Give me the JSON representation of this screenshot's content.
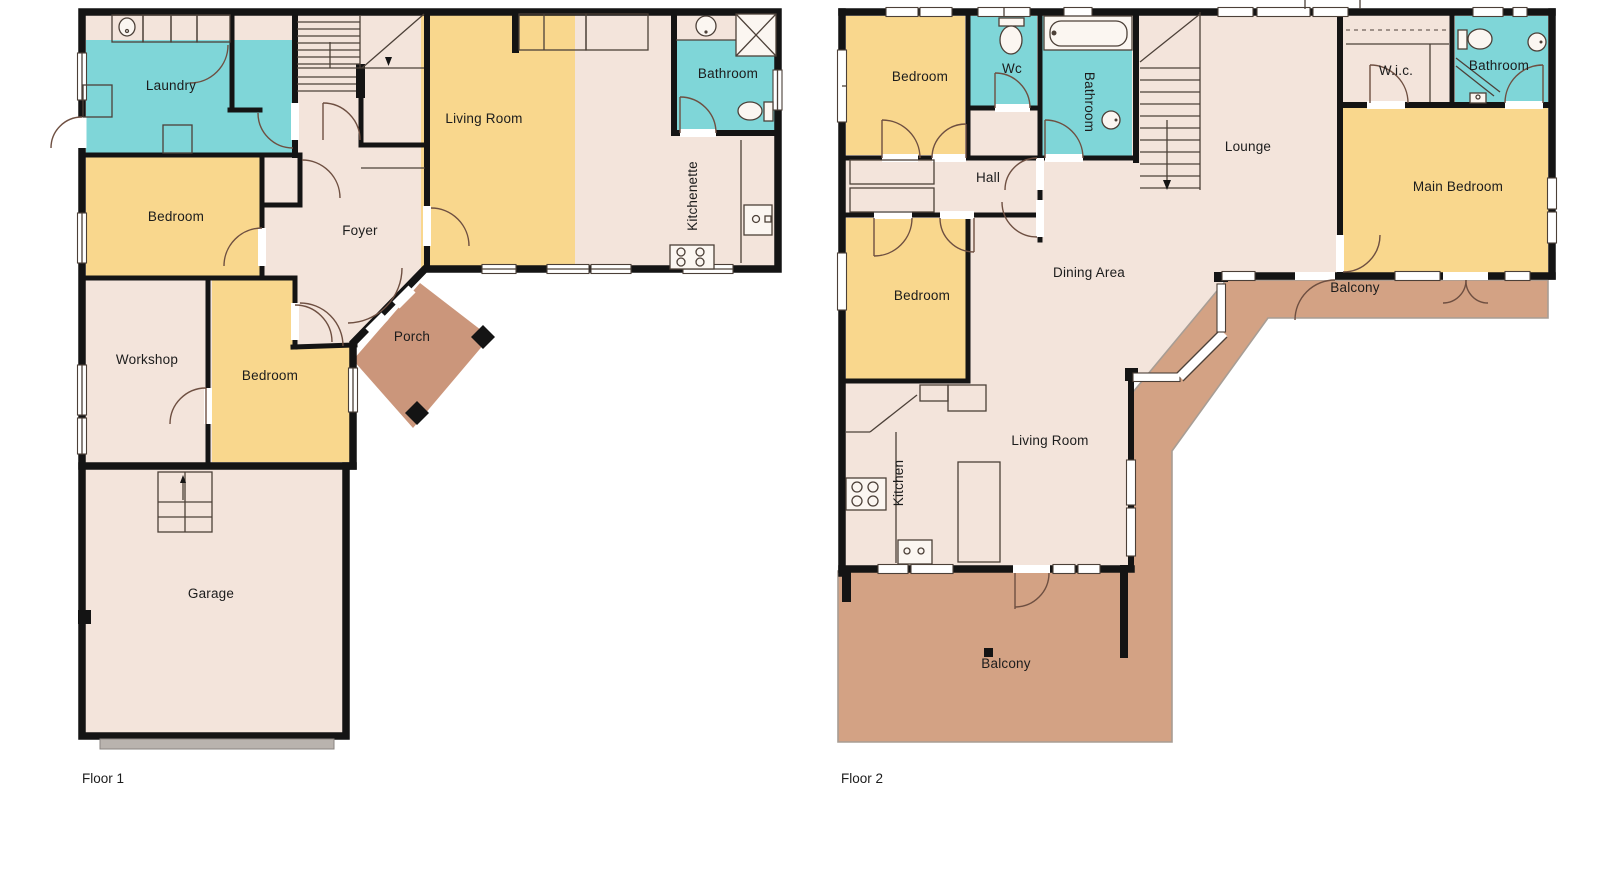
{
  "floor1": {
    "label": "Floor 1",
    "rooms": {
      "laundry": "Laundry",
      "bedroom_top": "Bedroom",
      "foyer": "Foyer",
      "living_room": "Living Room",
      "bathroom": "Bathroom",
      "kitchenette": "Kitchenette",
      "workshop": "Workshop",
      "bedroom_mid": "Bedroom",
      "porch": "Porch",
      "garage": "Garage"
    }
  },
  "floor2": {
    "label": "Floor 2",
    "rooms": {
      "bedroom_top": "Bedroom",
      "wc": "Wc",
      "bathroom_left": "Bathroom",
      "hall": "Hall",
      "lounge": "Lounge",
      "wic": "W.i.c.",
      "bathroom_right": "Bathroom",
      "main_bedroom": "Main Bedroom",
      "bedroom_mid": "Bedroom",
      "dining": "Dining Area",
      "balcony_top": "Balcony",
      "kitchen": "Kitchen",
      "living_room": "Living Room",
      "balcony_bottom": "Balcony"
    }
  },
  "colors": {
    "room_beige": "#f3e4db",
    "bedroom_yellow": "#f9d78d",
    "wet_teal": "#7fd6d8",
    "porch_brown": "#cb967b",
    "balcony_brown": "#d3a284",
    "wall_black": "#141414",
    "garage_door_gray": "#b9b3ae",
    "label_text": "#1c1c1c"
  },
  "fixtures": [
    "stairs-icon",
    "toilet-icon",
    "sink-icon",
    "bathtub-icon",
    "shower-icon",
    "stove-icon",
    "kitchen-sink-icon",
    "garage-door",
    "door-arc",
    "window"
  ]
}
